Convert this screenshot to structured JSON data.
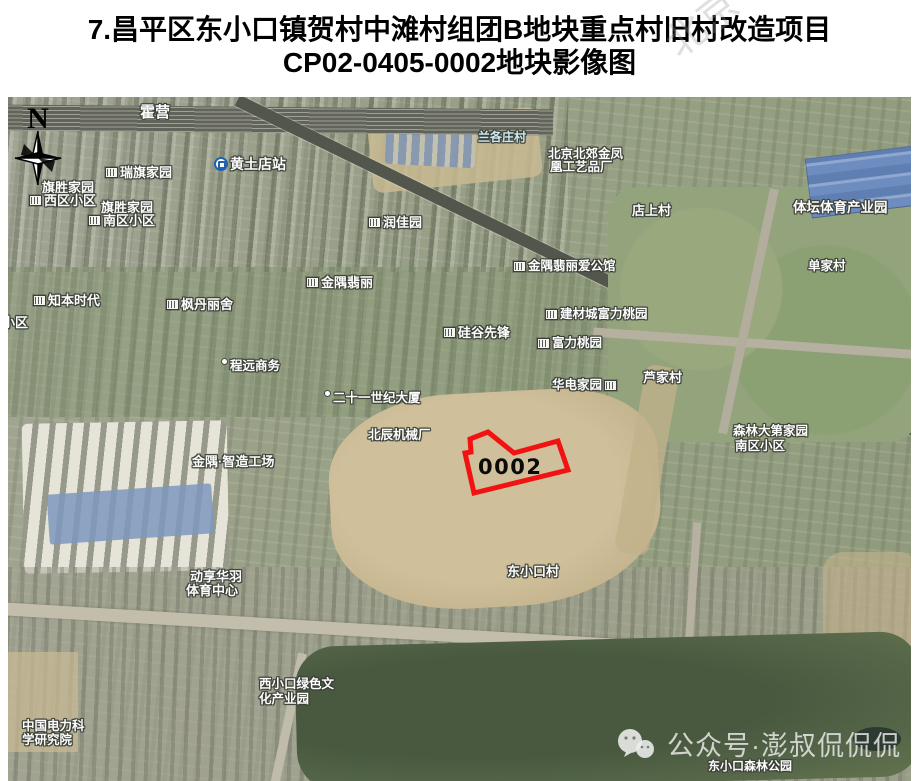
{
  "header": {
    "title_line1": "7.昌平区东小口镇贺村中滩村组团B地块重点村旧村改造项目",
    "title_line2": "CP02-0405-0002地块影像图",
    "faint_watermark": "北京"
  },
  "map": {
    "compass": {
      "label": "N"
    },
    "parcel": {
      "code": "0002",
      "outline_color": "#f11212",
      "points": "480,335 506,356 550,344 560,373 466,396 457,356 463,355 462,342",
      "label_x": 470,
      "label_y": 358
    },
    "labels": [
      {
        "text": "霍营",
        "x": 132,
        "y": 8,
        "fs": 15
      },
      {
        "text": "黄土店站",
        "x": 206,
        "y": 60,
        "fs": 14,
        "icon": "subway"
      },
      {
        "text": "瑞旗家园",
        "x": 97,
        "y": 69,
        "fs": 13,
        "icon": "building"
      },
      {
        "text": "旗胜家园",
        "x": 34,
        "y": 84,
        "fs": 13
      },
      {
        "text": "西区小区",
        "x": 21,
        "y": 97,
        "fs": 13,
        "icon": "building"
      },
      {
        "text": "旗胜家园",
        "x": 93,
        "y": 104,
        "fs": 13
      },
      {
        "text": "南区小区",
        "x": 80,
        "y": 117,
        "fs": 13,
        "icon": "building"
      },
      {
        "text": "兰各庄村",
        "x": 470,
        "y": 34,
        "fs": 12,
        "color": "#cbeaf2"
      },
      {
        "text": "北京北郊金凤",
        "x": 540,
        "y": 51,
        "fs": 12.5
      },
      {
        "text": "凰工艺品厂",
        "x": 542,
        "y": 64,
        "fs": 12.5
      },
      {
        "text": "店上村",
        "x": 624,
        "y": 107,
        "fs": 13
      },
      {
        "text": "体坛体育产业园",
        "x": 785,
        "y": 104,
        "fs": 13.5
      },
      {
        "text": "单家村",
        "x": 800,
        "y": 163,
        "fs": 12.5
      },
      {
        "text": "润佳园",
        "x": 360,
        "y": 119,
        "fs": 13,
        "icon": "building"
      },
      {
        "text": "金隅翡丽",
        "x": 298,
        "y": 179,
        "fs": 13,
        "icon": "building"
      },
      {
        "text": "知本时代",
        "x": 25,
        "y": 197,
        "fs": 13,
        "icon": "building"
      },
      {
        "text": "枫丹丽舍",
        "x": 158,
        "y": 201,
        "fs": 13,
        "icon": "building"
      },
      {
        "text": "小区",
        "x": -6,
        "y": 219,
        "fs": 13
      },
      {
        "text": "金隅翡丽爱公馆",
        "x": 505,
        "y": 163,
        "fs": 12.5,
        "icon": "building"
      },
      {
        "text": "硅谷先锋",
        "x": 435,
        "y": 229,
        "fs": 13,
        "icon": "building"
      },
      {
        "text": "建材城富力桃园",
        "x": 537,
        "y": 211,
        "fs": 12.5,
        "icon": "building"
      },
      {
        "text": "富力桃园",
        "x": 529,
        "y": 240,
        "fs": 12.5,
        "icon": "building"
      },
      {
        "text": "华电家园",
        "x": 544,
        "y": 282,
        "fs": 12.5,
        "icon": "building",
        "icon_side": "right"
      },
      {
        "text": "芦家村",
        "x": 635,
        "y": 274,
        "fs": 13
      },
      {
        "text": "森林大第家园",
        "x": 725,
        "y": 328,
        "fs": 12.5
      },
      {
        "text": "南区小区",
        "x": 727,
        "y": 343,
        "fs": 12.5
      },
      {
        "text": "程远商务",
        "x": 213,
        "y": 263,
        "fs": 12.5,
        "icon": "pin"
      },
      {
        "text": "二十一世纪大厦",
        "x": 316,
        "y": 295,
        "fs": 12.5,
        "icon": "pin"
      },
      {
        "text": "北辰机械厂",
        "x": 360,
        "y": 332,
        "fs": 12.5
      },
      {
        "text": "金隅·智造工场",
        "x": 184,
        "y": 358,
        "fs": 13
      },
      {
        "text": "东小口村",
        "x": 499,
        "y": 468,
        "fs": 13
      },
      {
        "text": "动享华羽",
        "x": 182,
        "y": 473,
        "fs": 13
      },
      {
        "text": "体育中心",
        "x": 178,
        "y": 487,
        "fs": 13
      },
      {
        "text": "西小口绿色文",
        "x": 251,
        "y": 581,
        "fs": 12.5
      },
      {
        "text": "化产业园",
        "x": 251,
        "y": 596,
        "fs": 12.5
      },
      {
        "text": "中国电力科",
        "x": 14,
        "y": 623,
        "fs": 12.5
      },
      {
        "text": "学研究院",
        "x": 14,
        "y": 637,
        "fs": 12.5
      },
      {
        "text": "东小口森林公园",
        "x": 700,
        "y": 663,
        "fs": 12
      }
    ],
    "watermark": {
      "text": "公众号·澎叔侃侃侃"
    }
  }
}
